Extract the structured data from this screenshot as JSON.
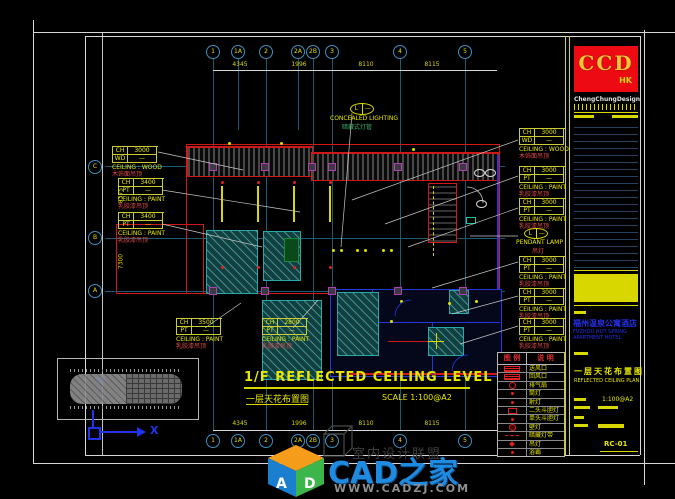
{
  "sheet": {
    "drawing_title": {
      "main": "1/F REFLECTED CEILING LEVEL",
      "sub_cn": "一层天花布置图",
      "scale": "SCALE  1:100@A2"
    },
    "grid": {
      "top_bubbles": [
        "1",
        "1A",
        "2",
        "2A",
        "2B",
        "3",
        "4",
        "5"
      ],
      "bottom_bubbles": [
        "1",
        "1A",
        "2",
        "2A",
        "2B",
        "3",
        "4",
        "5"
      ],
      "left_bubbles": [
        "C",
        "B",
        "A"
      ],
      "top_dims": [
        "4345",
        "1996",
        "8110",
        "8115"
      ],
      "bottom_dims": [
        "4345",
        "1996",
        "8110",
        "8115"
      ],
      "left_dims": [
        "8375",
        "7300"
      ]
    },
    "tags": {
      "l1": {
        "k1": "CH",
        "v1": "3000",
        "k2": "WD",
        "v2": "—",
        "en": "CEILING : WOOD",
        "cn": "木饰面吊顶"
      },
      "l2": {
        "k1": "CH",
        "v1": "3400",
        "k2": "PT",
        "v2": "—",
        "en": "CEILING : PAINT",
        "cn": "乳胶漆吊顶"
      },
      "l3": {
        "k1": "CH",
        "v1": "3400",
        "k2": "PT",
        "v2": "—",
        "en": "CEILING : PAINT",
        "cn": "乳胶漆吊顶"
      },
      "l4": {
        "k1": "CH",
        "v1": "3500",
        "k2": "PT",
        "v2": "—",
        "en": "CEILING : PAINT",
        "cn": "乳胶漆吊顶"
      },
      "l5": {
        "k1": "CH",
        "v1": "2800",
        "k2": "PT",
        "v2": "—",
        "en": "CEILING : PAINT",
        "cn": "乳胶漆吊顶"
      },
      "r1": {
        "k1": "CH",
        "v1": "3000",
        "k2": "WD",
        "v2": "—",
        "en": "CEILING : WOOD",
        "cn": "木饰面吊顶"
      },
      "r2": {
        "k1": "CH",
        "v1": "3000",
        "k2": "PT",
        "v2": "—",
        "en": "CEILING : PAINT",
        "cn": "乳胶漆吊顶"
      },
      "r3": {
        "k1": "CH",
        "v1": "3000",
        "k2": "PT",
        "v2": "—",
        "en": "CEILING : PAINT",
        "cn": "乳胶漆吊顶"
      },
      "r4": {
        "k1": "CH",
        "v1": "3000",
        "k2": "PT",
        "v2": "—",
        "en": "CEILING : PAINT",
        "cn": "乳胶漆吊顶"
      },
      "r5": {
        "k1": "CH",
        "v1": "3000",
        "k2": "PT",
        "v2": "—",
        "en": "CEILING : PAINT",
        "cn": "乳胶漆吊顶"
      },
      "r6": {
        "k1": "CH",
        "v1": "3000",
        "k2": "PT",
        "v2": "—",
        "en": "CEILING : PAINT",
        "cn": "乳胶漆吊顶"
      }
    },
    "callouts": {
      "concealed": {
        "tag": "L",
        "rev": "—",
        "en": "CONCEALED LIGHTING",
        "cn": "暗藏式灯管"
      },
      "pendant": {
        "tag": "L",
        "rev": "—",
        "en": "PENDANT LAMP",
        "cn": "吊灯"
      }
    },
    "legend": {
      "header_sym": "图 例",
      "header_desc": "说 明",
      "rows": [
        {
          "icon": "supply-air-grille",
          "label": "送风口"
        },
        {
          "icon": "return-air-grille",
          "label": "回风口"
        },
        {
          "icon": "exhaust-fan",
          "label": "排气扇"
        },
        {
          "icon": "downlight",
          "label": "筒灯"
        },
        {
          "icon": "spotlight",
          "label": "射灯"
        },
        {
          "icon": "double-head-light",
          "label": "二头斗胆灯"
        },
        {
          "icon": "single-head-light",
          "label": "单头斗胆灯"
        },
        {
          "icon": "wall-lamp",
          "label": "壁灯"
        },
        {
          "icon": "cove-light",
          "label": "暗藏灯带"
        },
        {
          "icon": "pendant-lamp",
          "label": "吊灯"
        },
        {
          "icon": "bath-heater",
          "label": "浴霸"
        }
      ]
    },
    "title_block": {
      "logo": "CCD",
      "logo_sub": "HK",
      "firm": "ChengChungDesign",
      "project_cn": "福州温泉公寓酒店",
      "project_en": "FUZHOU HOT SPRING APARTMENT HOTEL",
      "sheet_cn": "一层天花布置图",
      "sheet_en": "REFLECTED CEILING PLAN",
      "scale": "1:100@A2",
      "drawing_no": "RC-01"
    },
    "ucs": {
      "x_label": "X"
    }
  },
  "watermark": {
    "brand": "CAD之家",
    "url": "WWW.CADZJ.COM",
    "cube_left": "A",
    "cube_right": "D",
    "bg_text": "室内设计联盟"
  },
  "colors": {
    "accent_yellow": "#e8e800",
    "wall_red": "#d01818",
    "wall_blue": "#2238dd",
    "teal": "#28a8a8",
    "brand_blue": "#1e8ae0",
    "logo_red": "#ee0a12"
  }
}
